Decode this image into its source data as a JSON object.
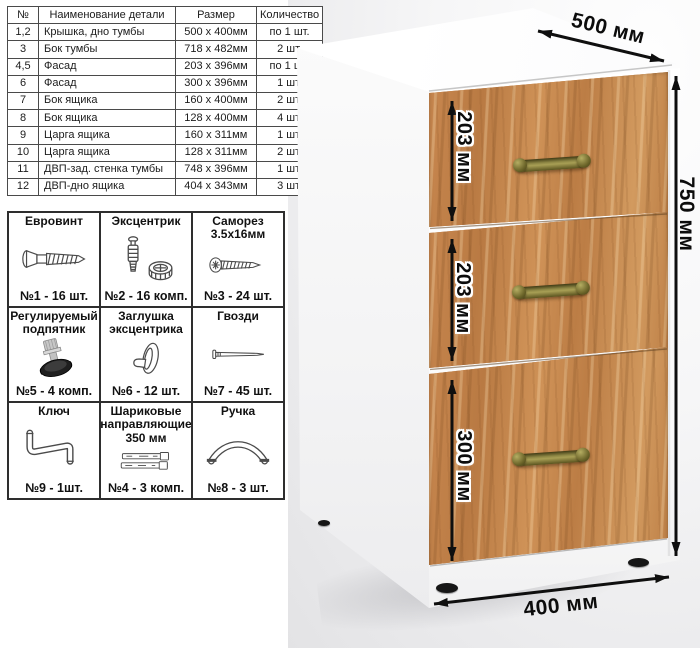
{
  "parts_table": {
    "headers": [
      "№",
      "Наименование детали",
      "Размер",
      "Количество"
    ],
    "rows": [
      [
        "1,2",
        "Крышка, дно тумбы",
        "500 x 400мм",
        "по 1 шт."
      ],
      [
        "3",
        "Бок тумбы",
        "718 x 482мм",
        "2 шт."
      ],
      [
        "4,5",
        "Фасад",
        "203 x 396мм",
        "по 1 шт."
      ],
      [
        "6",
        "Фасад",
        "300 x 396мм",
        "1 шт."
      ],
      [
        "7",
        "Бок ящика",
        "160 x 400мм",
        "2 шт."
      ],
      [
        "8",
        "Бок ящика",
        "128 x 400мм",
        "4 шт."
      ],
      [
        "9",
        "Царга ящика",
        "160 x 311мм",
        "1 шт."
      ],
      [
        "10",
        "Царга ящика",
        "128 x 311мм",
        "2 шт."
      ],
      [
        "11",
        "ДВП-зад. стенка тумбы",
        "748 x 396мм",
        "1 шт."
      ],
      [
        "12",
        "ДВП-дно ящика",
        "404 x 343мм",
        "3 шт."
      ]
    ]
  },
  "hardware": [
    {
      "title": "Евровинт",
      "qty": "№1 - 16 шт.",
      "icon": "euro-screw-icon"
    },
    {
      "title": "Эксцентрик",
      "qty": "№2 - 16 комп.",
      "icon": "cam-lock-icon"
    },
    {
      "title": "Саморез 3.5х16мм",
      "qty": "№3 - 24 шт.",
      "icon": "self-tapping-screw-icon"
    },
    {
      "title": "Регулируемый подпятник",
      "qty": "№5 - 4 комп.",
      "icon": "adjustable-foot-icon"
    },
    {
      "title": "Заглушка эксцентрика",
      "qty": "№6 - 12 шт.",
      "icon": "cam-cap-icon"
    },
    {
      "title": "Гвозди",
      "qty": "№7 - 45 шт.",
      "icon": "nail-icon"
    },
    {
      "title": "Ключ",
      "qty": "№9 - 1шт.",
      "icon": "hex-key-icon"
    },
    {
      "title": "Шариковые направляющие 350 мм",
      "qty": "№4 - 3 комп.",
      "icon": "drawer-slides-icon"
    },
    {
      "title": "Ручка",
      "qty": "№8 - 3 шт.",
      "icon": "pull-handle-icon"
    }
  ],
  "cabinet": {
    "width_label": "500 мм",
    "height_label": "750 мм",
    "depth_label": "400 мм",
    "drawer_heights": [
      "203 мм",
      "203 мм",
      "300 мм"
    ],
    "colors": {
      "wood": "#c2824c",
      "handle_brass": "#a89f55",
      "body_white": "#ffffff",
      "arrow_black": "#0f0f0f"
    }
  }
}
